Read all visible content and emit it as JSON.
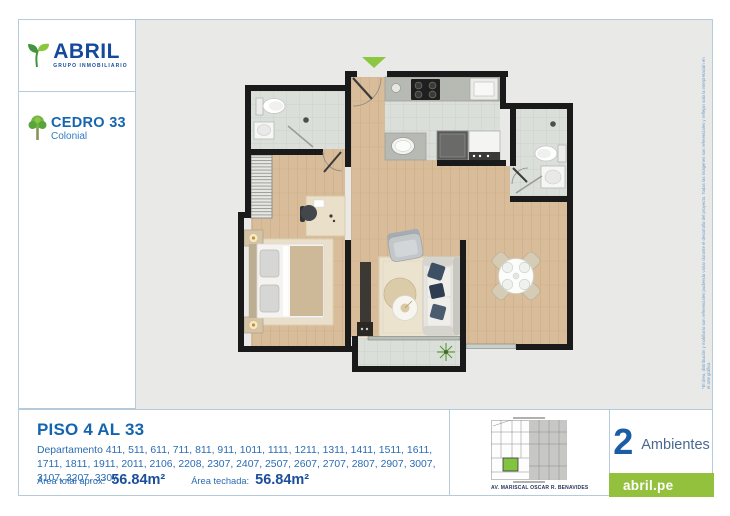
{
  "header": {
    "brand": {
      "name": "ABRIL",
      "tagline": "GRUPO INMOBILIARIO"
    },
    "project": {
      "name": "CEDRO 33",
      "variant": "Colonial"
    }
  },
  "plan": {
    "entrance_marker": "entrance-arrow",
    "disclaimer": "*El área, distribución y mobiliario son referenciales pudiendo variar durante el desarrollo del proyecto. Todas las imágenes son referenciales y reflejan solo la interpretación en el arte gráfico."
  },
  "details": {
    "floor_range": "PISO 4 AL 33",
    "departments": "Departamento 411, 511, 611, 711, 811, 911, 1011, 1111, 1211, 1311, 1411, 1511, 1611, 1711, 1811, 1911, 2011, 2106, 2208, 2307, 2407, 2507, 2607, 2707, 2807, 2907, 3007, 3107, 3207, 3307",
    "area_total_label": "Área total aprox:",
    "area_total_value": "56.84m²",
    "area_covered_label": "Área techada:",
    "area_covered_value": "56.84m²"
  },
  "map": {
    "caption": "AV. MARISCAL OSCAR R. BENAVIDES"
  },
  "summary": {
    "rooms_value": "2",
    "rooms_label": "Ambientes",
    "website": "abril.pe"
  },
  "colors": {
    "brand_blue": "#15499c",
    "accent_blue": "#1566af",
    "green_accent": "#8dc63f",
    "green_box": "#93c13e",
    "panel_border": "#b5cadb",
    "plan_background": "#e9eae8",
    "wood_floor": "#d9bd9a",
    "tile_floor": "#dbdfd9",
    "wall": "#1a1a1a"
  }
}
